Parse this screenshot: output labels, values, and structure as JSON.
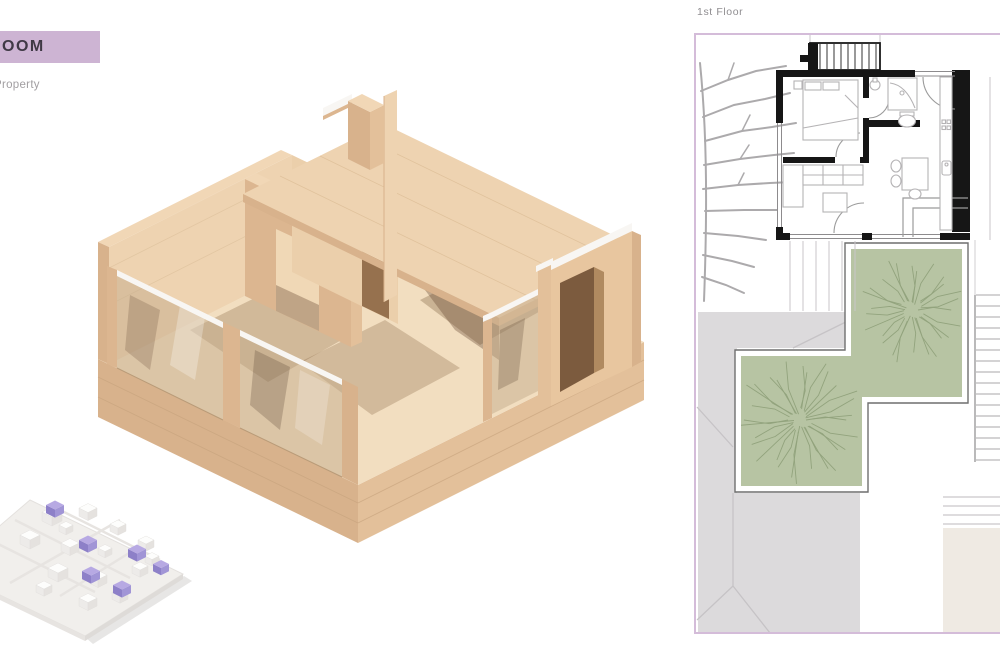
{
  "header": {
    "title": "OOM",
    "subtitle": "Property"
  },
  "plan": {
    "label": "1st Floor"
  },
  "palette": {
    "banner_bg": "#cdb4d3",
    "banner_text": "#3f3945",
    "subtitle_text": "#a19ea1",
    "plan_label_text": "#8f8d90",
    "plan_frame": "#d4bcd9",
    "wall_black": "#161616",
    "furniture_line": "#b5b3b5",
    "thin_line": "#8d8b8d",
    "paving": "#dcdadc",
    "paving_line": "#c6c3c6",
    "beige": "#efeae3",
    "garden_green": "#b7c4a3",
    "garden_outline": "#6f6f6f",
    "tree_line": "#92a37d",
    "branch_gray": "#acaaac",
    "wood_top": "#f1d7b6",
    "wood_light": "#eed3b1",
    "wood_left": "#d8b28c",
    "wood_right": "#e3c09a",
    "wood_mid": "#dcb690",
    "wood_floor": "#f2dec0",
    "glass": "#c4ac8c",
    "white_strip": "#f8f6f3",
    "shadow_brown": "#7c5b3e",
    "mini_plate": "#f1efec",
    "mini_purple_top": "#b7a9e3",
    "mini_purple_left": "#8d80c8",
    "mini_purple_right": "#a195d6"
  }
}
